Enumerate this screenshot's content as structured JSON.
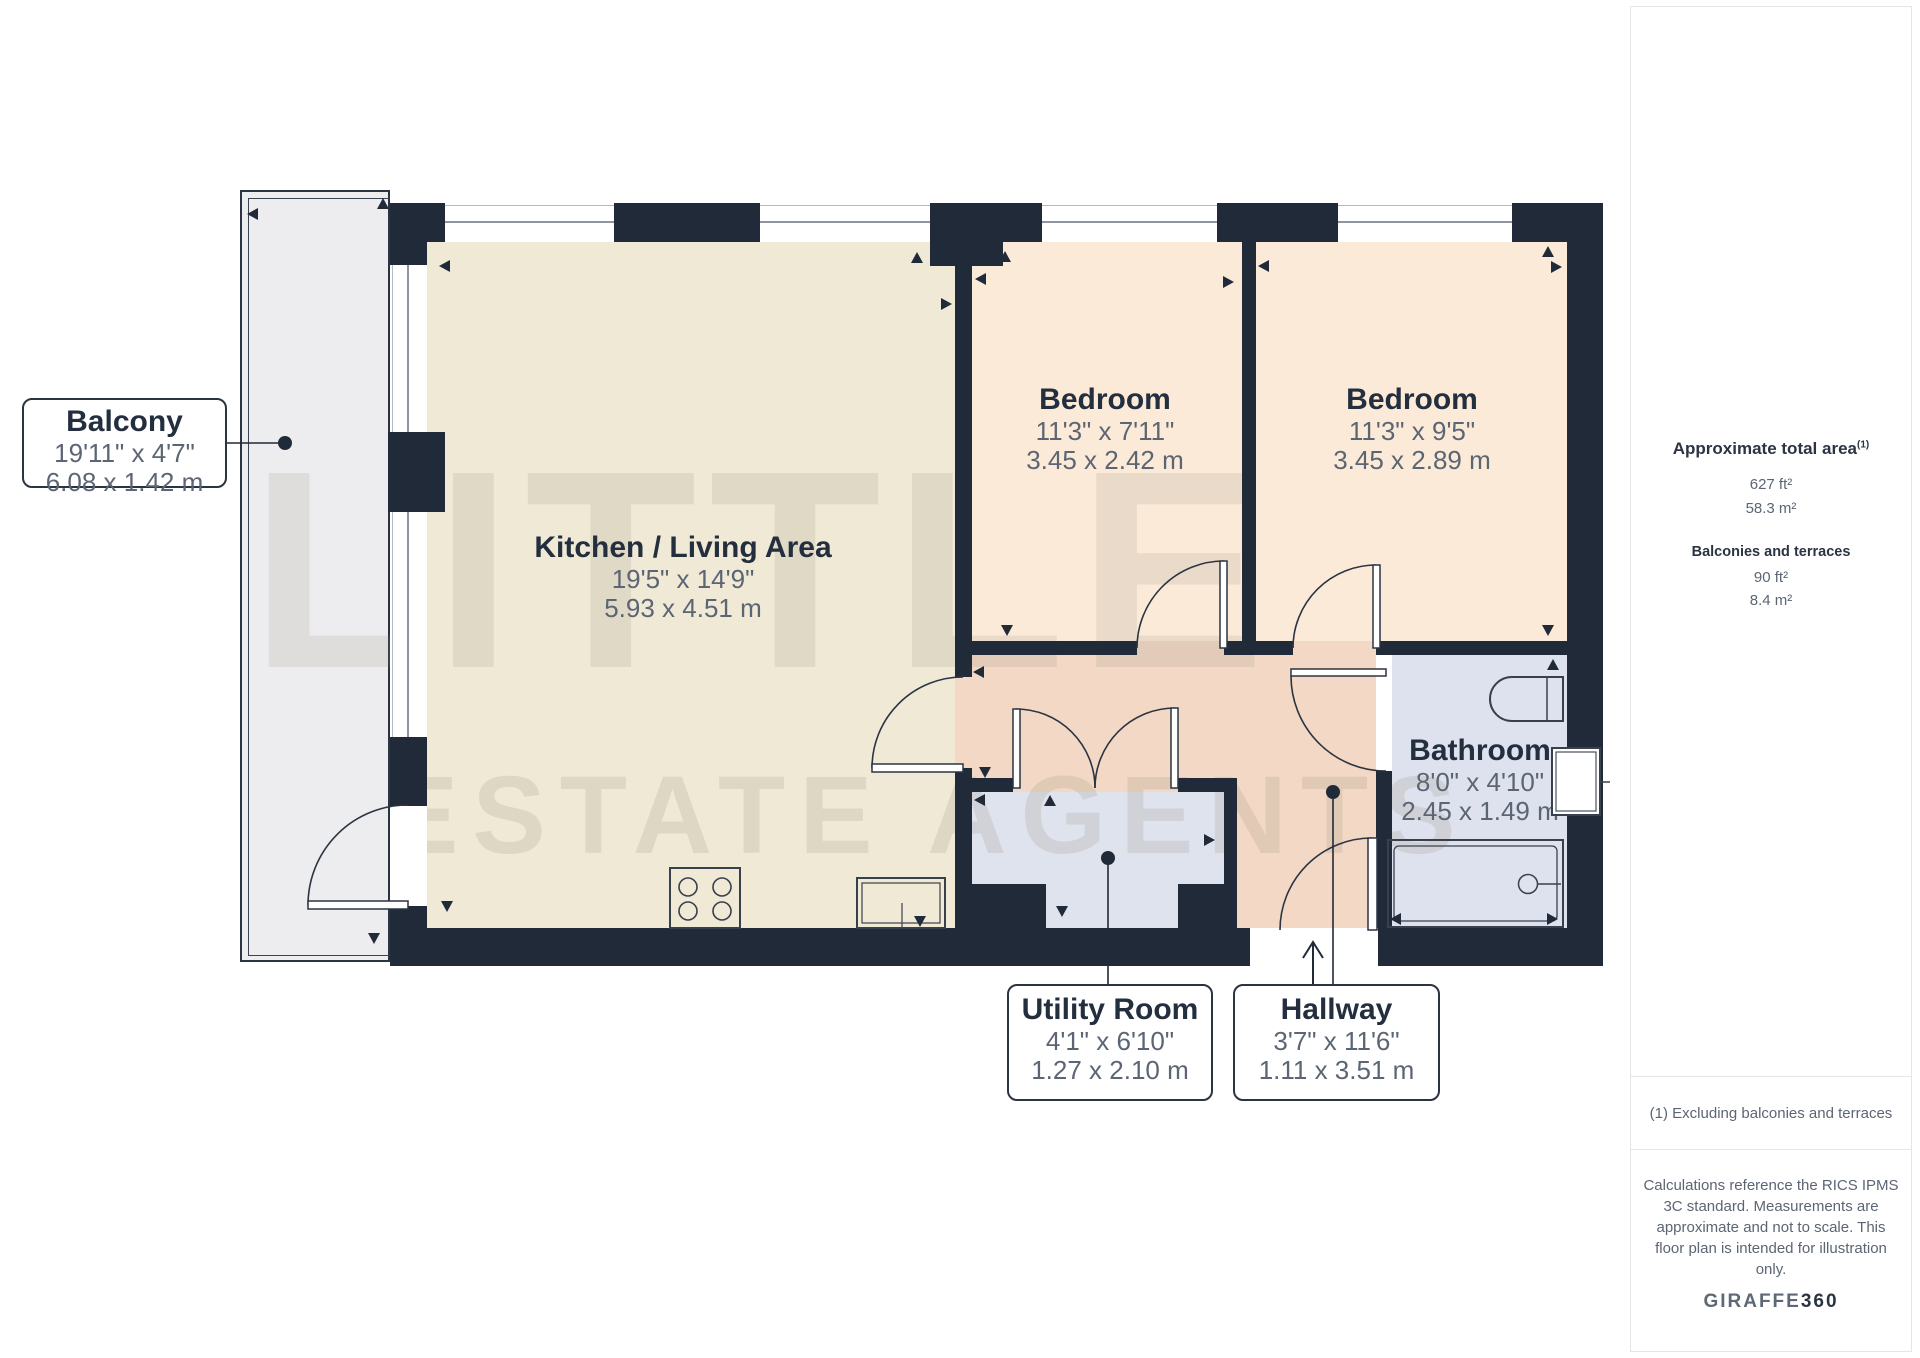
{
  "watermark": {
    "line1": "LITTLE",
    "line2": "ESTATE AGENTS"
  },
  "rooms": {
    "kitchen": {
      "name": "Kitchen / Living Area",
      "imperial": "19'5\" x 14'9\"",
      "metric": "5.93 x 4.51 m"
    },
    "bedroom1": {
      "name": "Bedroom",
      "imperial": "11'3\" x 7'11\"",
      "metric": "3.45 x 2.42 m"
    },
    "bedroom2": {
      "name": "Bedroom",
      "imperial": "11'3\" x 9'5\"",
      "metric": "3.45 x 2.89 m"
    },
    "bathroom": {
      "name": "Bathroom",
      "imperial": "8'0\" x 4'10\"",
      "metric": "2.45 x 1.49 m"
    },
    "utility": {
      "name": "Utility Room",
      "imperial": "4'1\" x 6'10\"",
      "metric": "1.27 x 2.10 m"
    },
    "hallway": {
      "name": "Hallway",
      "imperial": "3'7\" x 11'6\"",
      "metric": "1.11 x 3.51 m"
    },
    "balcony": {
      "name": "Balcony",
      "imperial": "19'11\" x 4'7\"",
      "metric": "6.08 x 1.42 m"
    }
  },
  "sidebar": {
    "total_area_label": "Approximate total area",
    "total_area_sup": "(1)",
    "total_area_ft": "627 ft²",
    "total_area_m": "58.3 m²",
    "balconies_label": "Balconies and terraces",
    "balconies_ft": "90 ft²",
    "balconies_m": "8.4 m²",
    "footnote": "(1) Excluding balconies and terraces",
    "disclaimer_lines": [
      "Calculations reference the RICS IPMS",
      "3C standard. Measurements are",
      "approximate and not to scale. This",
      "floor plan is intended for illustration",
      "only."
    ],
    "brand_name": "GIRAFFE",
    "brand_suffix": "360"
  },
  "colors": {
    "wall": "#202a38",
    "kitchen_floor": "#efe9d6",
    "bedroom_floor": "#fcead9",
    "hallway_floor": "#f2d8c5",
    "utility_floor": "#dfe3ee",
    "bathroom_floor": "#dde2ee",
    "balcony_floor": "#ededef",
    "dim_text": "#5c6573",
    "title_text": "#232e3e"
  }
}
